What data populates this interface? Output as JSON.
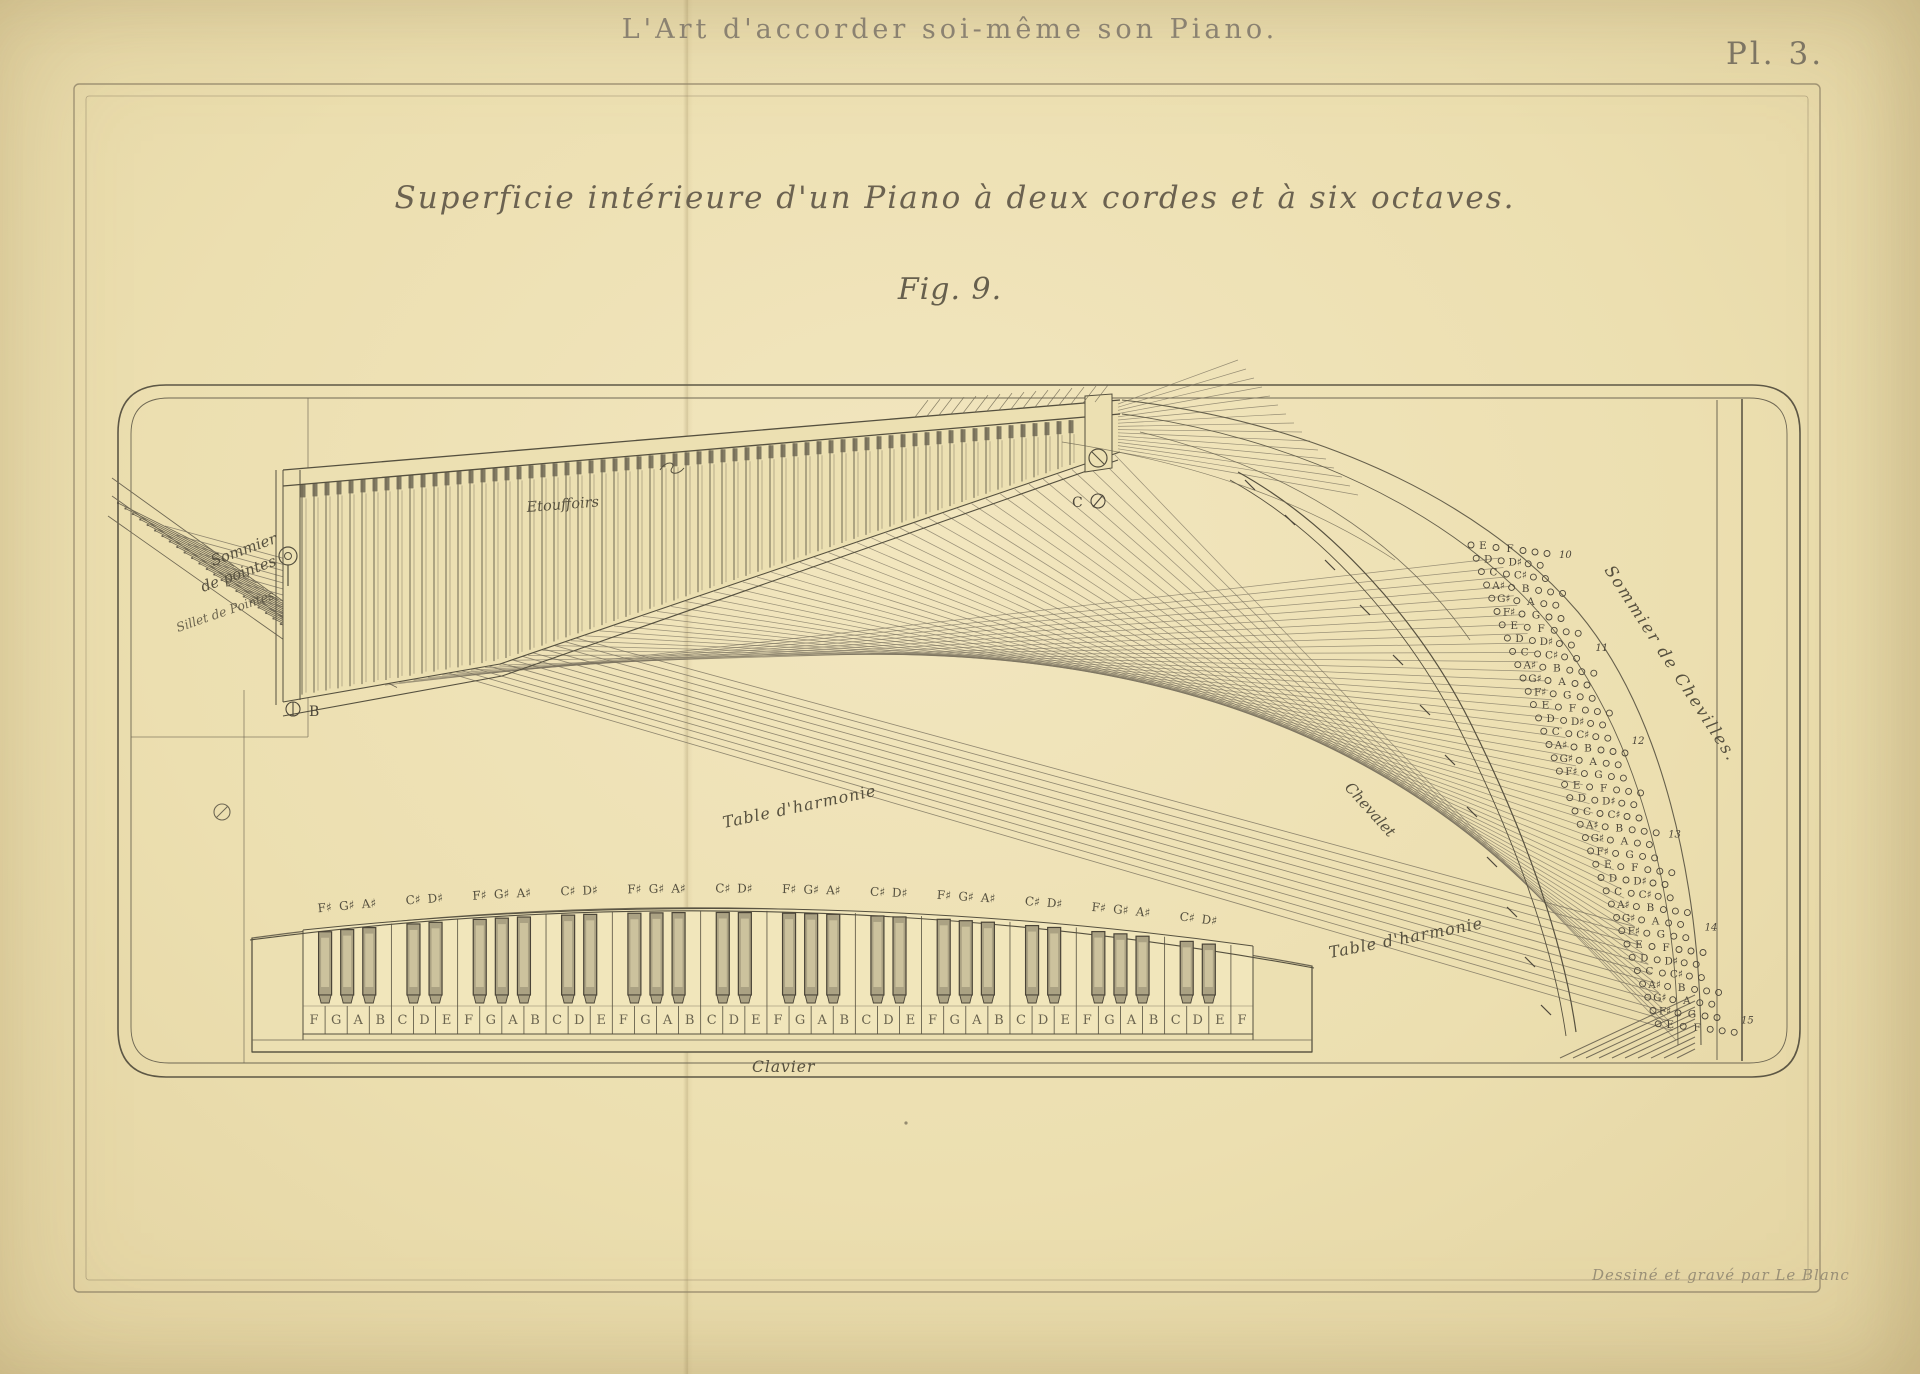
{
  "page": {
    "header_title": "L'Art d'accorder soi-même son Piano.",
    "plate_number": "Pl. 3.",
    "subtitle": "Superficie intérieure d'un Piano à deux cordes et à six octaves.",
    "figure_label": "Fig. 9.",
    "credit": "Dessiné et gravé par Le Blanc",
    "colors": {
      "paper": "#ece0b2",
      "ink": "#4c463a",
      "line": "#6e6753",
      "letterpress": "#8b8271"
    }
  },
  "labels": {
    "sommier_pointes_line1": "Sommier",
    "sommier_pointes_line2": "de pointes",
    "sillet": "Sillet de Pointes",
    "etouffoirs": "Etouffoirs",
    "table_harmonie_mid": "Table d'harmonie",
    "chevalet": "Chevalet",
    "table_harmonie_right": "Table d'harmonie",
    "sommier_chevilles": "Sommier de Chevilles.",
    "clavier": "Clavier",
    "mark_left_letter": "B",
    "mark_right_letter": "C"
  },
  "pinblock": {
    "rows": [
      {
        "n1": "E",
        "n2": "F",
        "gauge": "10"
      },
      {
        "n1": "D",
        "n2": "D♯",
        "gauge": ""
      },
      {
        "n1": "C",
        "n2": "C♯",
        "gauge": ""
      },
      {
        "n1": "A♯",
        "n2": "B",
        "gauge": ""
      },
      {
        "n1": "G♯",
        "n2": "A",
        "gauge": ""
      },
      {
        "n1": "F♯",
        "n2": "G",
        "gauge": ""
      },
      {
        "n1": "E",
        "n2": "F",
        "gauge": ""
      },
      {
        "n1": "D",
        "n2": "D♯",
        "gauge": "11"
      },
      {
        "n1": "C",
        "n2": "C♯",
        "gauge": ""
      },
      {
        "n1": "A♯",
        "n2": "B",
        "gauge": ""
      },
      {
        "n1": "G♯",
        "n2": "A",
        "gauge": ""
      },
      {
        "n1": "F♯",
        "n2": "G",
        "gauge": ""
      },
      {
        "n1": "E",
        "n2": "F",
        "gauge": ""
      },
      {
        "n1": "D",
        "n2": "D♯",
        "gauge": ""
      },
      {
        "n1": "C",
        "n2": "C♯",
        "gauge": "12"
      },
      {
        "n1": "A♯",
        "n2": "B",
        "gauge": ""
      },
      {
        "n1": "G♯",
        "n2": "A",
        "gauge": ""
      },
      {
        "n1": "F♯",
        "n2": "G",
        "gauge": ""
      },
      {
        "n1": "E",
        "n2": "F",
        "gauge": ""
      },
      {
        "n1": "D",
        "n2": "D♯",
        "gauge": ""
      },
      {
        "n1": "C",
        "n2": "C♯",
        "gauge": ""
      },
      {
        "n1": "A♯",
        "n2": "B",
        "gauge": "13"
      },
      {
        "n1": "G♯",
        "n2": "A",
        "gauge": ""
      },
      {
        "n1": "F♯",
        "n2": "G",
        "gauge": ""
      },
      {
        "n1": "E",
        "n2": "F",
        "gauge": ""
      },
      {
        "n1": "D",
        "n2": "D♯",
        "gauge": ""
      },
      {
        "n1": "C",
        "n2": "C♯",
        "gauge": ""
      },
      {
        "n1": "A♯",
        "n2": "B",
        "gauge": ""
      },
      {
        "n1": "G♯",
        "n2": "A",
        "gauge": "14"
      },
      {
        "n1": "F♯",
        "n2": "G",
        "gauge": ""
      },
      {
        "n1": "E",
        "n2": "F",
        "gauge": ""
      },
      {
        "n1": "D",
        "n2": "D♯",
        "gauge": ""
      },
      {
        "n1": "C",
        "n2": "C♯",
        "gauge": ""
      },
      {
        "n1": "A♯",
        "n2": "B",
        "gauge": ""
      },
      {
        "n1": "G♯",
        "n2": "A",
        "gauge": ""
      },
      {
        "n1": "F♯",
        "n2": "G",
        "gauge": "15"
      },
      {
        "n1": "E",
        "n2": "F",
        "gauge": ""
      }
    ]
  },
  "keyboard": {
    "white_keys": [
      "F",
      "G",
      "A",
      "B",
      "C",
      "D",
      "E",
      "F",
      "G",
      "A",
      "B",
      "C",
      "D",
      "E",
      "F",
      "G",
      "A",
      "B",
      "C",
      "D",
      "E",
      "F",
      "G",
      "A",
      "B",
      "C",
      "D",
      "E",
      "F",
      "G",
      "A",
      "B",
      "C",
      "D",
      "E",
      "F",
      "G",
      "A",
      "B",
      "C",
      "D",
      "E",
      "F"
    ],
    "black_labels": [
      "F♯",
      "G♯",
      "A♯",
      "C♯",
      "D♯"
    ],
    "black_offsets": [
      0,
      1,
      2,
      4,
      5
    ],
    "octaves": 6
  }
}
